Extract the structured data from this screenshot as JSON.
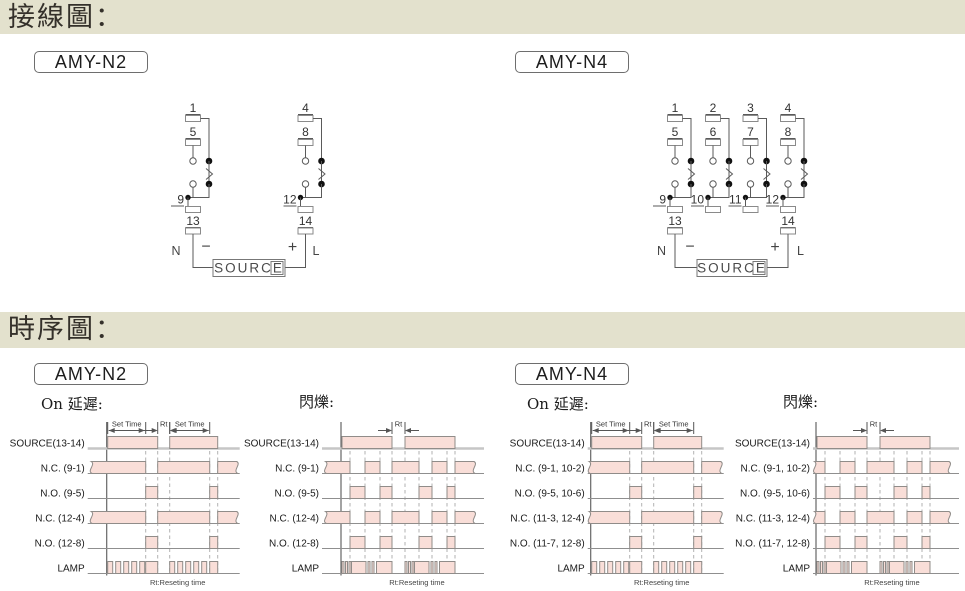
{
  "section_headers": {
    "wiring": "接線圖：",
    "timing": "時序圖："
  },
  "model_labels": {
    "wiring_n2": "AMY-N2",
    "wiring_n4": "AMY-N4",
    "timing_n2": "AMY-N2",
    "timing_n4": "AMY-N4"
  },
  "colors": {
    "band_bg": "#e3e1cd",
    "pulse_fill": "#f9ded8",
    "pulse_stroke": "#908c89",
    "baseline": "#8f8f8f",
    "source_baseline": "#c6c6c6",
    "dashed": "#b2b2b2",
    "line": "#5a5a5a",
    "box_stroke": "#8a8a8a",
    "text": "#222222"
  },
  "wiring_diagrams": [
    {
      "id": "n2",
      "model": "AMY-N2",
      "poles": [
        {
          "top": "1",
          "mid": "5",
          "common": "9"
        },
        {
          "top": "4",
          "mid": "8",
          "common": "12"
        }
      ],
      "bottom_terminals": [
        "13",
        "14"
      ],
      "power_labels": {
        "neutral": "N",
        "minus": "−",
        "plus": "+",
        "line": "L"
      },
      "source_label": "SOURCE"
    },
    {
      "id": "n4",
      "model": "AMY-N4",
      "poles": [
        {
          "top": "1",
          "mid": "5",
          "common": "9"
        },
        {
          "top": "2",
          "mid": "6",
          "common": "10"
        },
        {
          "top": "3",
          "mid": "7",
          "common": "11"
        },
        {
          "top": "4",
          "mid": "8",
          "common": "12"
        }
      ],
      "bottom_terminals": [
        "13",
        "14"
      ],
      "power_labels": {
        "neutral": "N",
        "minus": "−",
        "plus": "+",
        "line": "L"
      },
      "source_label": "SOURCE"
    }
  ],
  "timing_charts": [
    {
      "model": "AMY-N2",
      "caption": "On 延遲:",
      "type": "timing-waveform",
      "plot_width": 130,
      "footnote": "Rt:Reseting time",
      "annotations": [
        {
          "style": "span",
          "text": "Set Time",
          "from": 1,
          "to": 39
        },
        {
          "style": "between",
          "text": "Rt",
          "from": 51,
          "to": 63
        },
        {
          "style": "span",
          "text": "Set Time",
          "from": 63,
          "to": 103
        }
      ],
      "dashed_lines": [
        39,
        51,
        63,
        103,
        111
      ],
      "rows": [
        {
          "label": "SOURCE(13-14)",
          "segments": [
            [
              1,
              51
            ],
            [
              63,
              111
            ]
          ]
        },
        {
          "label": "N.C.  (9-1)",
          "torn": true,
          "segments": [
            [
              -16,
              39
            ],
            [
              51,
              103
            ],
            [
              111,
              130
            ]
          ]
        },
        {
          "label": "N.O.  (9-5)",
          "segments": [
            [
              39,
              51
            ],
            [
              103,
              111
            ]
          ]
        },
        {
          "label": "N.C. (12-4)",
          "torn": true,
          "segments": [
            [
              -16,
              39
            ],
            [
              51,
              103
            ],
            [
              111,
              130
            ]
          ]
        },
        {
          "label": "N.O. (12-8)",
          "segments": [
            [
              39,
              51
            ],
            [
              103,
              111
            ]
          ]
        },
        {
          "label": "LAMP",
          "segments": [
            [
              1,
              6
            ],
            [
              9,
              14
            ],
            [
              17,
              22
            ],
            [
              25,
              30
            ],
            [
              33,
              38
            ],
            [
              39,
              51
            ],
            [
              63,
              68
            ],
            [
              71,
              76
            ],
            [
              79,
              84
            ],
            [
              87,
              92
            ],
            [
              95,
              100
            ],
            [
              103,
              111
            ]
          ]
        }
      ]
    },
    {
      "model": "AMY-N2",
      "caption": "閃爍:",
      "type": "timing-waveform",
      "plot_width": 140,
      "footnote": "Rt:Reseting time",
      "annotations": [
        {
          "style": "between",
          "text": "Rt",
          "from": 51,
          "to": 64
        }
      ],
      "dashed_lines": [
        9,
        24,
        39,
        51,
        64,
        78,
        91,
        106,
        114
      ],
      "rows": [
        {
          "label": "SOURCE(13-14)",
          "segments": [
            [
              1,
              51
            ],
            [
              64,
              114
            ]
          ]
        },
        {
          "label": "N.C.  (9-1)",
          "torn": true,
          "segments": [
            [
              -16,
              9
            ],
            [
              24,
              39
            ],
            [
              51,
              78
            ],
            [
              91,
              106
            ],
            [
              114,
              133
            ]
          ]
        },
        {
          "label": "N.O.  (9-5)",
          "segments": [
            [
              9,
              24
            ],
            [
              39,
              51
            ],
            [
              78,
              91
            ],
            [
              106,
              114
            ]
          ]
        },
        {
          "label": "N.C. (12-4)",
          "torn": true,
          "segments": [
            [
              -16,
              9
            ],
            [
              24,
              39
            ],
            [
              51,
              78
            ],
            [
              91,
              106
            ],
            [
              114,
              133
            ]
          ]
        },
        {
          "label": "N.O. (12-8)",
          "segments": [
            [
              9,
              24
            ],
            [
              39,
              51
            ],
            [
              78,
              91
            ],
            [
              106,
              114
            ]
          ]
        },
        {
          "label": "LAMP",
          "segments": [
            [
              1,
              3
            ],
            [
              4.5,
              6.5
            ],
            [
              8,
              10
            ],
            [
              10.5,
              25
            ],
            [
              27,
              29
            ],
            [
              31,
              33
            ],
            [
              35.5,
              51
            ],
            [
              64,
              66
            ],
            [
              67.5,
              69.5
            ],
            [
              71,
              73
            ],
            [
              73.5,
              88
            ],
            [
              90,
              92
            ],
            [
              94,
              96
            ],
            [
              98.5,
              114
            ]
          ]
        }
      ]
    },
    {
      "model": "AMY-N4",
      "caption": "On 延遲:",
      "type": "timing-waveform",
      "plot_width": 130,
      "footnote": "Rt:Reseting time",
      "annotations": [
        {
          "style": "span",
          "text": "Set Time",
          "from": 1,
          "to": 39
        },
        {
          "style": "between",
          "text": "Rt",
          "from": 51,
          "to": 63
        },
        {
          "style": "span",
          "text": "Set Time",
          "from": 63,
          "to": 103
        }
      ],
      "dashed_lines": [
        39,
        51,
        63,
        103,
        111
      ],
      "rows": [
        {
          "label": "SOURCE(13-14)",
          "segments": [
            [
              1,
              51
            ],
            [
              63,
              111
            ]
          ]
        },
        {
          "label": "N.C.  (9-1, 10-2)",
          "torn": true,
          "segments": [
            [
              -2,
              39
            ],
            [
              51,
              103
            ],
            [
              111,
              130
            ]
          ]
        },
        {
          "label": "N.O.  (9-5, 10-6)",
          "segments": [
            [
              39,
              51
            ],
            [
              103,
              111
            ]
          ]
        },
        {
          "label": "N.C. (11-3, 12-4)",
          "torn": true,
          "segments": [
            [
              -2,
              39
            ],
            [
              51,
              103
            ],
            [
              111,
              130
            ]
          ]
        },
        {
          "label": "N.O. (11-7, 12-8)",
          "segments": [
            [
              39,
              51
            ],
            [
              103,
              111
            ]
          ]
        },
        {
          "label": "LAMP",
          "segments": [
            [
              1,
              6
            ],
            [
              9,
              14
            ],
            [
              17,
              22
            ],
            [
              25,
              30
            ],
            [
              33,
              38
            ],
            [
              39,
              51
            ],
            [
              63,
              68
            ],
            [
              71,
              76
            ],
            [
              79,
              84
            ],
            [
              87,
              92
            ],
            [
              95,
              100
            ],
            [
              103,
              111
            ]
          ]
        }
      ]
    },
    {
      "model": "AMY-N4",
      "caption": "閃爍:",
      "type": "timing-waveform",
      "plot_width": 140,
      "footnote": "Rt:Reseting time",
      "annotations": [
        {
          "style": "between",
          "text": "Rt",
          "from": 51,
          "to": 64
        }
      ],
      "dashed_lines": [
        9,
        24,
        39,
        51,
        64,
        78,
        91,
        106,
        114
      ],
      "rows": [
        {
          "label": "SOURCE(13-14)",
          "segments": [
            [
              1,
              51
            ],
            [
              64,
              114
            ]
          ]
        },
        {
          "label": "N.C.  (9-1, 10-2)",
          "torn": true,
          "segments": [
            [
              -2,
              9
            ],
            [
              24,
              39
            ],
            [
              51,
              78
            ],
            [
              91,
              106
            ],
            [
              114,
              133
            ]
          ]
        },
        {
          "label": "N.O.  (9-5, 10-6)",
          "segments": [
            [
              9,
              24
            ],
            [
              39,
              51
            ],
            [
              78,
              91
            ],
            [
              106,
              114
            ]
          ]
        },
        {
          "label": "N.C. (11-3, 12-4)",
          "torn": true,
          "segments": [
            [
              -2,
              9
            ],
            [
              24,
              39
            ],
            [
              51,
              78
            ],
            [
              91,
              106
            ],
            [
              114,
              133
            ]
          ]
        },
        {
          "label": "N.O. (11-7, 12-8)",
          "segments": [
            [
              9,
              24
            ],
            [
              39,
              51
            ],
            [
              78,
              91
            ],
            [
              106,
              114
            ]
          ]
        },
        {
          "label": "LAMP",
          "segments": [
            [
              1,
              3
            ],
            [
              4.5,
              6.5
            ],
            [
              8,
              10
            ],
            [
              10.5,
              25
            ],
            [
              27,
              29
            ],
            [
              31,
              33
            ],
            [
              35.5,
              51
            ],
            [
              64,
              66
            ],
            [
              67.5,
              69.5
            ],
            [
              71,
              73
            ],
            [
              73.5,
              88
            ],
            [
              90,
              92
            ],
            [
              94,
              96
            ],
            [
              98.5,
              114
            ]
          ]
        }
      ]
    }
  ]
}
